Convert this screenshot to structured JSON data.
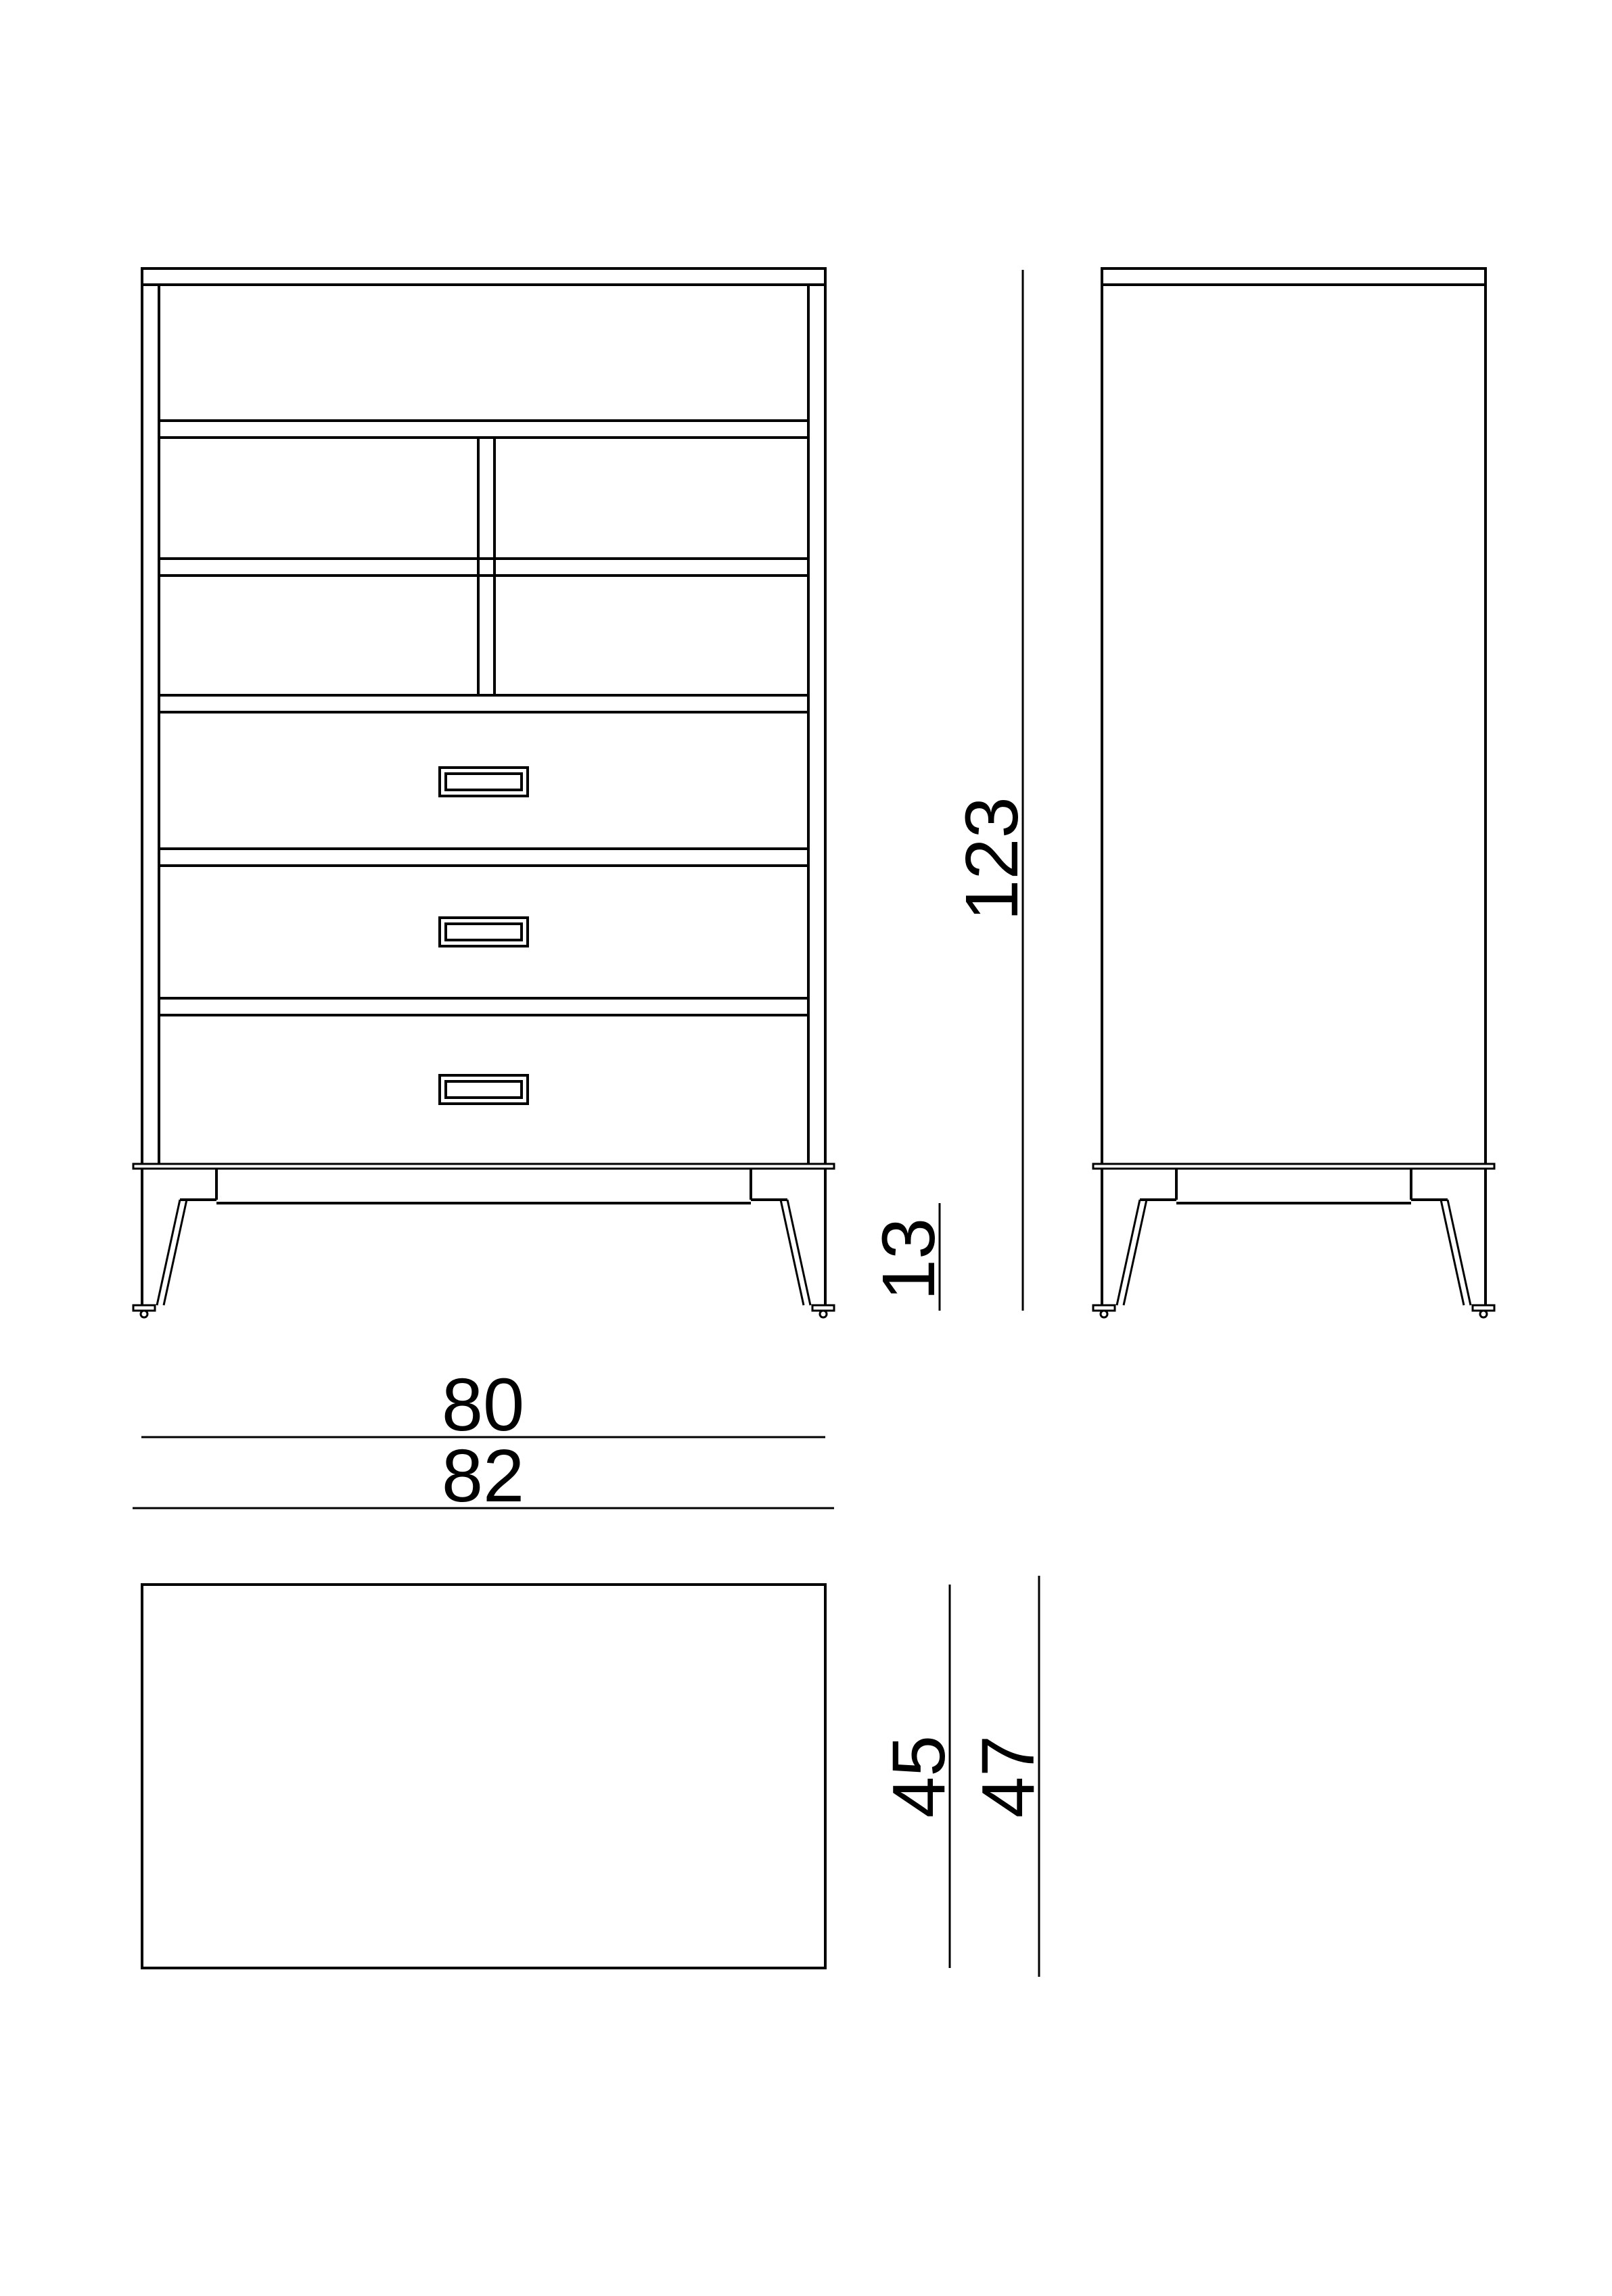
{
  "page": {
    "background": "#ffffff",
    "line_color": "#000000",
    "text_color": "#000000"
  },
  "dimensions": {
    "total_height_cm": "123",
    "leg_height_cm": "13",
    "carcass_width_cm": "80",
    "overall_width_cm": "82",
    "carcass_depth_cm": "45",
    "overall_depth_cm": "47"
  }
}
